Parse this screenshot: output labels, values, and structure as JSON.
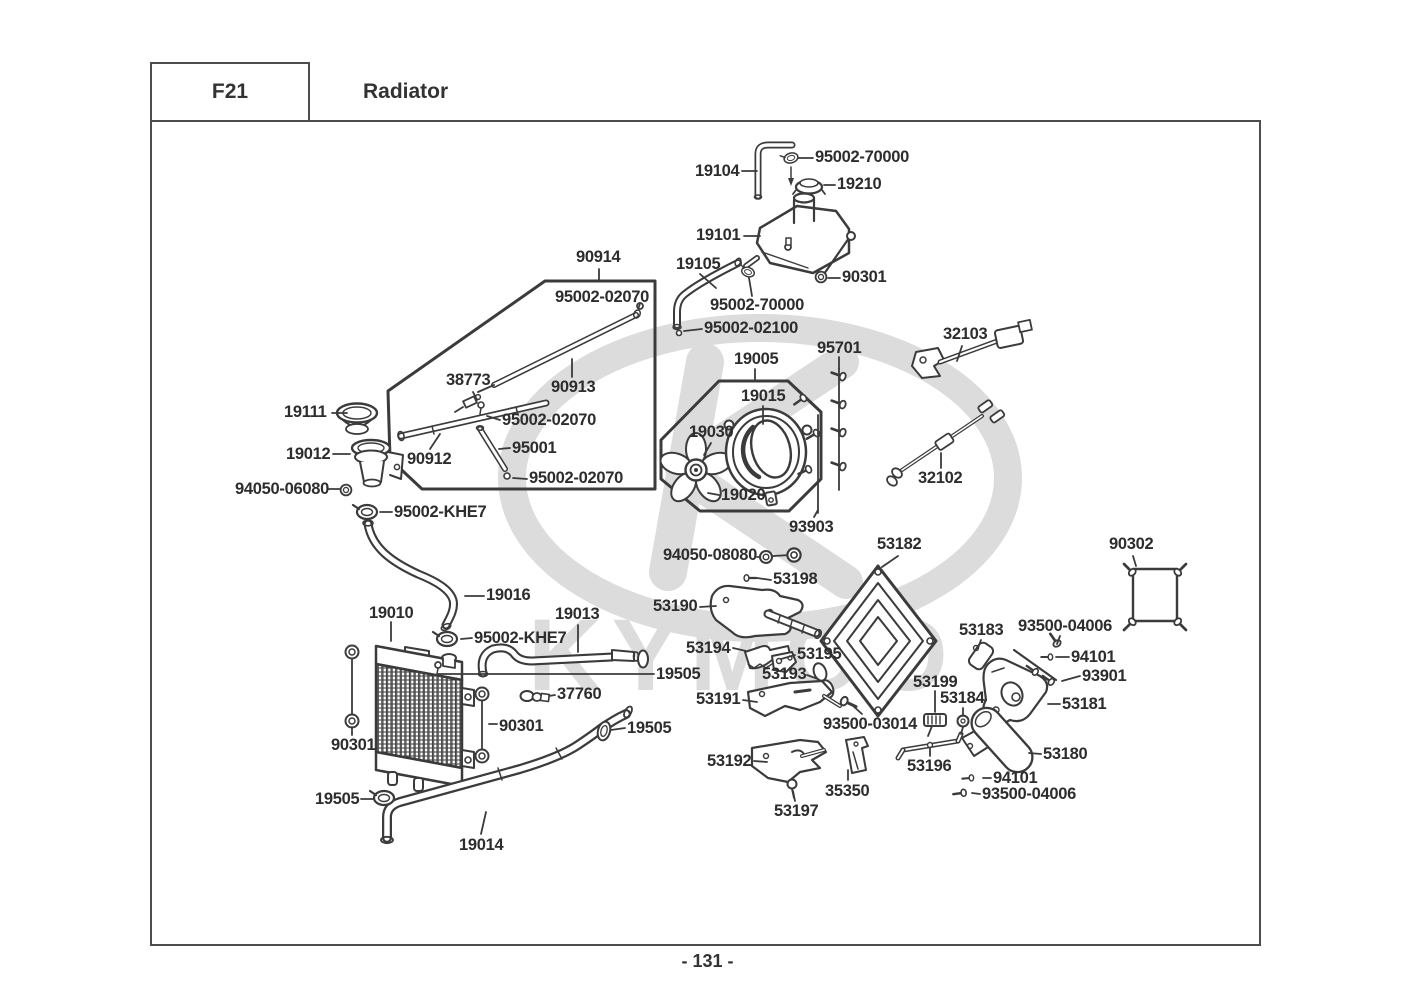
{
  "header": {
    "section_code": "F21",
    "title": "Radiator"
  },
  "page_number": "- 131 -",
  "watermark": "KYMCO",
  "colors": {
    "line": "#3b3b3b",
    "label": "#2d2d2d",
    "watermark": "#dcdcdc"
  },
  "labels": [
    {
      "text": "19104",
      "x": 695,
      "y": 162
    },
    {
      "text": "95002-70000",
      "x": 815,
      "y": 148
    },
    {
      "text": "19210",
      "x": 837,
      "y": 175
    },
    {
      "text": "19101",
      "x": 696,
      "y": 226
    },
    {
      "text": "19105",
      "x": 676,
      "y": 255
    },
    {
      "text": "90301",
      "x": 842,
      "y": 268
    },
    {
      "text": "90914",
      "x": 576,
      "y": 248
    },
    {
      "text": "95002-02070",
      "x": 555,
      "y": 288
    },
    {
      "text": "95002-70000",
      "x": 710,
      "y": 296
    },
    {
      "text": "95002-02100",
      "x": 704,
      "y": 319
    },
    {
      "text": "32103",
      "x": 943,
      "y": 325
    },
    {
      "text": "95701",
      "x": 817,
      "y": 339
    },
    {
      "text": "19005",
      "x": 734,
      "y": 350
    },
    {
      "text": "38773",
      "x": 446,
      "y": 371
    },
    {
      "text": "90913",
      "x": 551,
      "y": 378
    },
    {
      "text": "19015",
      "x": 741,
      "y": 387
    },
    {
      "text": "19111",
      "x": 284,
      "y": 403
    },
    {
      "text": "95002-02070",
      "x": 502,
      "y": 411
    },
    {
      "text": "19030",
      "x": 689,
      "y": 423
    },
    {
      "text": "19012",
      "x": 286,
      "y": 445
    },
    {
      "text": "95001",
      "x": 512,
      "y": 439
    },
    {
      "text": "90912",
      "x": 407,
      "y": 450
    },
    {
      "text": "32102",
      "x": 918,
      "y": 469
    },
    {
      "text": "95002-02070",
      "x": 529,
      "y": 469
    },
    {
      "text": "94050-06080",
      "x": 235,
      "y": 480
    },
    {
      "text": "19020",
      "x": 721,
      "y": 486
    },
    {
      "text": "95002-KHE7",
      "x": 394,
      "y": 503
    },
    {
      "text": "93903",
      "x": 789,
      "y": 518
    },
    {
      "text": "53182",
      "x": 877,
      "y": 535
    },
    {
      "text": "90302",
      "x": 1109,
      "y": 535
    },
    {
      "text": "94050-08080",
      "x": 663,
      "y": 546
    },
    {
      "text": "53198",
      "x": 773,
      "y": 570
    },
    {
      "text": "19016",
      "x": 486,
      "y": 586
    },
    {
      "text": "53190",
      "x": 653,
      "y": 597
    },
    {
      "text": "19010",
      "x": 369,
      "y": 604
    },
    {
      "text": "19013",
      "x": 555,
      "y": 605
    },
    {
      "text": "93500-04006",
      "x": 1018,
      "y": 617
    },
    {
      "text": "53183",
      "x": 959,
      "y": 621
    },
    {
      "text": "95002-KHE7",
      "x": 474,
      "y": 629
    },
    {
      "text": "53194",
      "x": 686,
      "y": 639
    },
    {
      "text": "53195",
      "x": 797,
      "y": 645
    },
    {
      "text": "94101",
      "x": 1071,
      "y": 648
    },
    {
      "text": "19505",
      "x": 656,
      "y": 665
    },
    {
      "text": "53193",
      "x": 762,
      "y": 665
    },
    {
      "text": "93901",
      "x": 1082,
      "y": 667
    },
    {
      "text": "53199",
      "x": 913,
      "y": 673
    },
    {
      "text": "37760",
      "x": 557,
      "y": 685
    },
    {
      "text": "53184",
      "x": 940,
      "y": 689
    },
    {
      "text": "53191",
      "x": 696,
      "y": 690
    },
    {
      "text": "53181",
      "x": 1062,
      "y": 695
    },
    {
      "text": "93500-03014",
      "x": 823,
      "y": 715
    },
    {
      "text": "90301",
      "x": 499,
      "y": 717
    },
    {
      "text": "19505",
      "x": 627,
      "y": 719
    },
    {
      "text": "90301",
      "x": 331,
      "y": 736
    },
    {
      "text": "53180",
      "x": 1043,
      "y": 745
    },
    {
      "text": "53192",
      "x": 707,
      "y": 752
    },
    {
      "text": "53196",
      "x": 907,
      "y": 757
    },
    {
      "text": "94101",
      "x": 993,
      "y": 769
    },
    {
      "text": "35350",
      "x": 825,
      "y": 782
    },
    {
      "text": "93500-04006",
      "x": 982,
      "y": 785
    },
    {
      "text": "19505",
      "x": 315,
      "y": 790
    },
    {
      "text": "53197",
      "x": 774,
      "y": 802
    },
    {
      "text": "19014",
      "x": 459,
      "y": 836
    }
  ]
}
